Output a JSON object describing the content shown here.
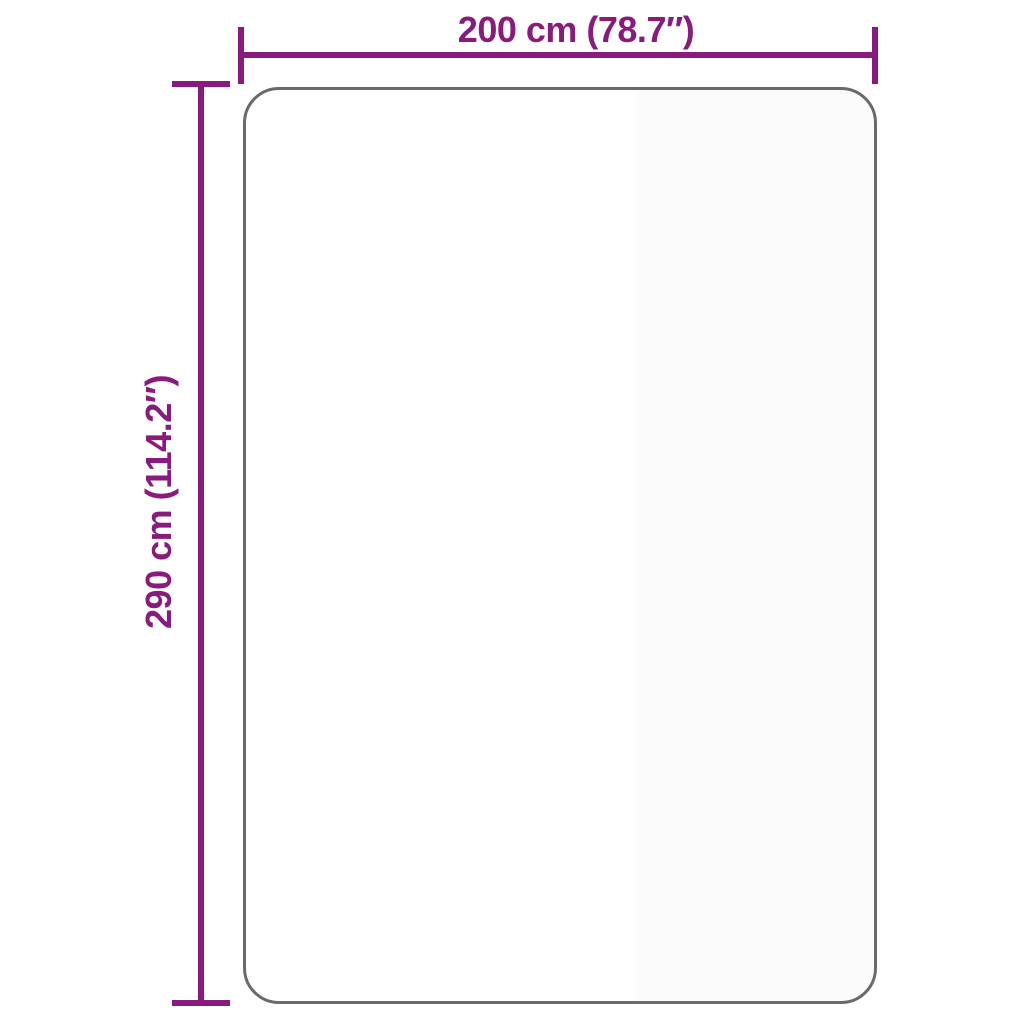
{
  "diagram": {
    "type": "product-dimension-diagram",
    "width_label": "200 cm (78.7″)",
    "height_label": "290 cm (114.2″)",
    "width_cm": 200,
    "width_inches": 78.7,
    "height_cm": 290,
    "height_inches": 114.2,
    "colors": {
      "dimension": "#8A1B7D",
      "outline": "#6A6A6A",
      "background": "#FFFFFF"
    }
  }
}
